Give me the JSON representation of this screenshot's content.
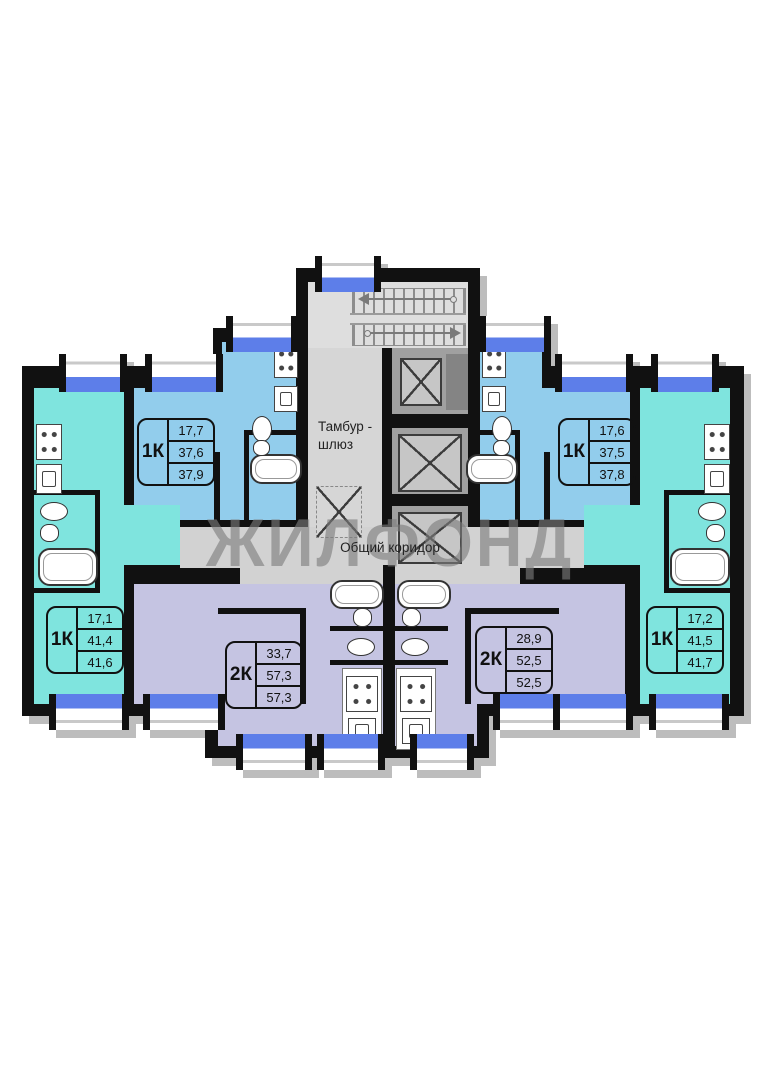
{
  "watermark": "ЖИЛФОНД",
  "rooms": {
    "vestibule_line1": "Тамбур -",
    "vestibule_line2": "шлюз",
    "corridor": "Общий коридор"
  },
  "apartments": [
    {
      "id": "one-room-top-left",
      "type": "1К",
      "areas": [
        "17,7",
        "37,6",
        "37,9"
      ]
    },
    {
      "id": "one-room-top-right",
      "type": "1К",
      "areas": [
        "17,6",
        "37,5",
        "37,8"
      ]
    },
    {
      "id": "one-room-bottom-left",
      "type": "1К",
      "areas": [
        "17,1",
        "41,4",
        "41,6"
      ]
    },
    {
      "id": "one-room-bottom-right",
      "type": "1К",
      "areas": [
        "17,2",
        "41,5",
        "41,7"
      ]
    },
    {
      "id": "two-room-left",
      "type": "2К",
      "areas": [
        "33,7",
        "57,3",
        "57,3"
      ]
    },
    {
      "id": "two-room-right",
      "type": "2К",
      "areas": [
        "28,9",
        "52,5",
        "52,5"
      ]
    }
  ],
  "colors": {
    "one_room_blue": "#92cdec",
    "one_room_teal": "#7fe4de",
    "two_room_lavender": "#c5c4e2",
    "corridor_gray": "#d2d2d2",
    "wall_black": "#111111",
    "window_blue": "#5d7ee9"
  }
}
